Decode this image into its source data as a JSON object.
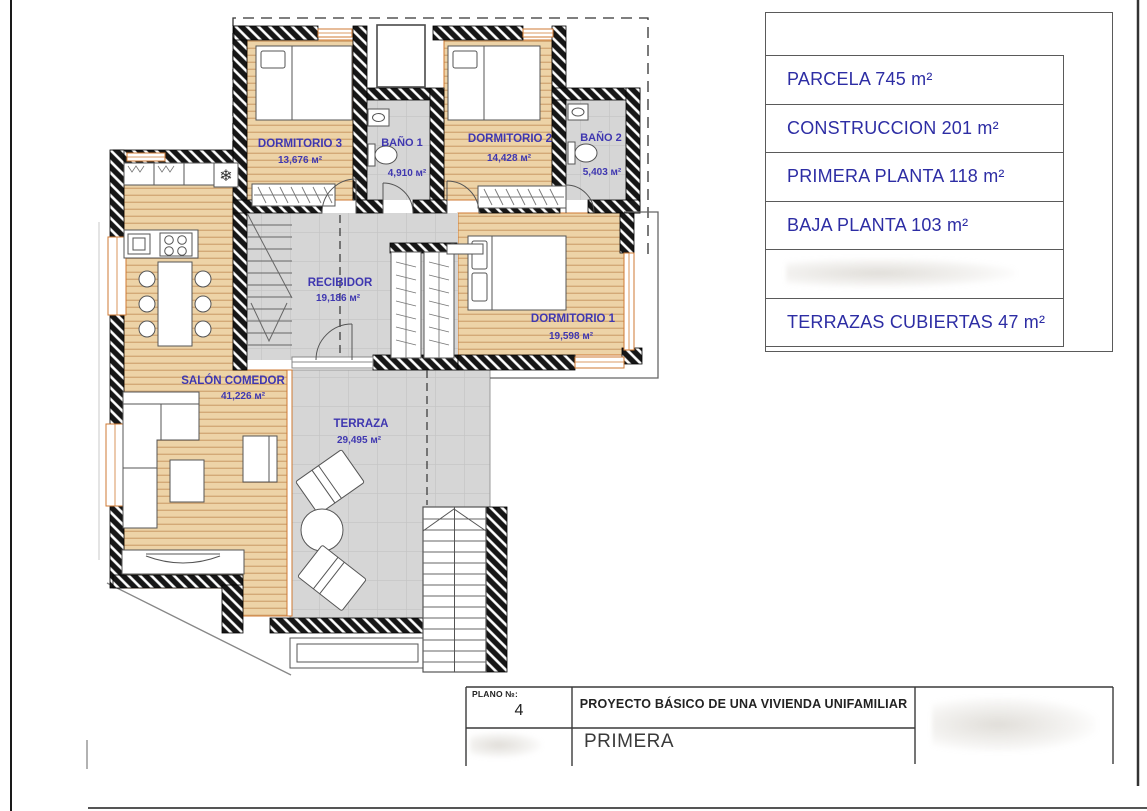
{
  "legend": {
    "rows": [
      {
        "text": "PARCELA 745 m²"
      },
      {
        "text": "CONSTRUCCION 201 m²"
      },
      {
        "text": "PRIMERA PLANTA 118 m²"
      },
      {
        "text": "BAJA PLANTA 103 m²"
      },
      {
        "text": ""
      },
      {
        "text": "TERRAZAS CUBIERTAS 47 m²"
      }
    ]
  },
  "plan": {
    "rooms": {
      "dormitorio3": {
        "name": "DORMITORIO 3",
        "area": "13,676 м²"
      },
      "bano1": {
        "name": "BAÑO 1",
        "area": "4,910 м²"
      },
      "dormitorio2": {
        "name": "DORMITORIO 2",
        "area": "14,428 м²"
      },
      "bano2": {
        "name": "BAÑO 2",
        "area": "5,403 м²"
      },
      "recibidor": {
        "name": "RECIBIDOR",
        "area": "19,186 м²"
      },
      "dormitorio1": {
        "name": "DORMITORIO 1",
        "area": "19,598 м²"
      },
      "salon": {
        "name": "SALÓN COMEDOR",
        "area": "41,226 м²"
      },
      "terraza": {
        "name": "TERRAZA",
        "area": "29,495 м²"
      }
    },
    "symbols": {
      "fridge": "❄"
    }
  },
  "title_block": {
    "plano_label": "PLANO №:",
    "plano_number": "4",
    "project_title": "PROYECTO BÁSICO DE UNA VIVIENDA UNIFAMILIAR",
    "sheet_name": "PRIMERA"
  },
  "colors": {
    "room_label_blue": "#3f37b0",
    "legend_navy": "#2d2da4",
    "wood_floor": "#edd3a7",
    "tile_floor": "#d6d6d6",
    "window_orange": "#cf7a33",
    "wall_black": "#161616"
  }
}
